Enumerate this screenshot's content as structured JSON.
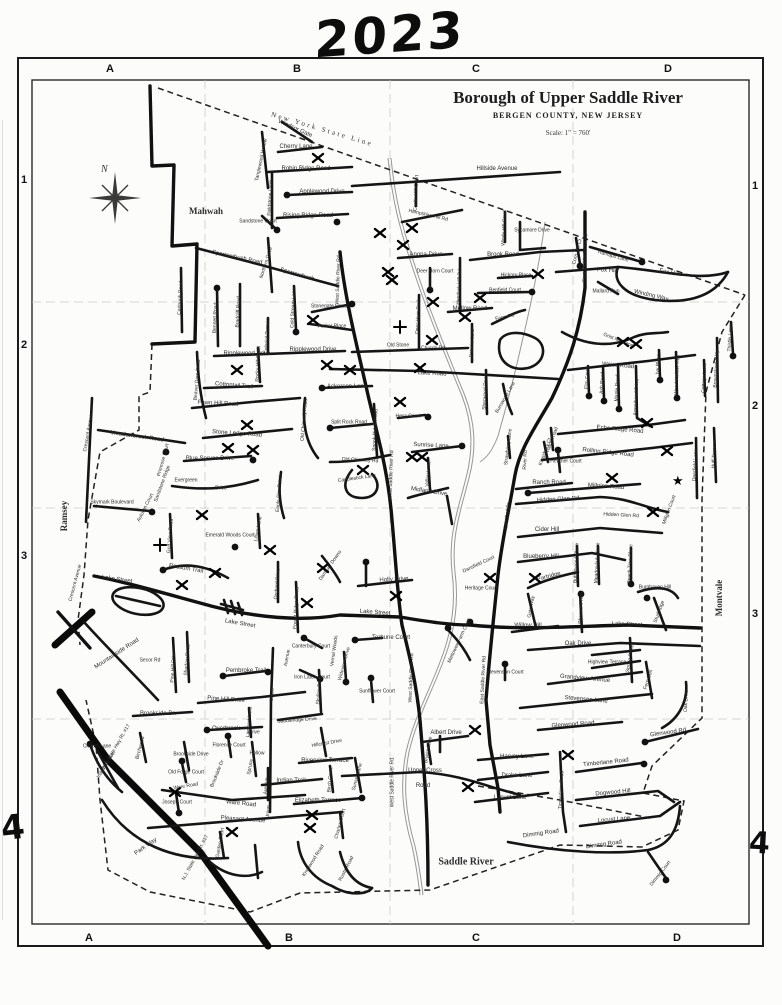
{
  "annotations": {
    "year": "2023",
    "hand4_left": "4",
    "hand4_right": "4"
  },
  "title": {
    "main": "Borough of Upper Saddle River",
    "sub": "BERGEN COUNTY, NEW JERSEY",
    "scale": "Scale: 1\" = 760'"
  },
  "municipalities": {
    "mahwah": "Mahwah",
    "ramsey": "Ramsey",
    "montvale": "Montvale",
    "saddle_river": "Saddle River",
    "state_line": "New York State Line"
  },
  "compass": {
    "north": "N"
  },
  "grid": {
    "top": [
      {
        "t": "A",
        "x": 110
      },
      {
        "t": "B",
        "x": 297
      },
      {
        "t": "C",
        "x": 476
      },
      {
        "t": "D",
        "x": 668
      }
    ],
    "bottom": [
      {
        "t": "A",
        "x": 89
      },
      {
        "t": "B",
        "x": 289
      },
      {
        "t": "C",
        "x": 476
      },
      {
        "t": "D",
        "x": 677
      }
    ],
    "left": [
      {
        "t": "1",
        "y": 180
      },
      {
        "t": "2",
        "y": 345
      },
      {
        "t": "3",
        "y": 556
      }
    ],
    "right": [
      {
        "t": "1",
        "y": 186
      },
      {
        "t": "2",
        "y": 406
      },
      {
        "t": "3",
        "y": 614
      }
    ]
  },
  "street_labels": [
    [
      "Windsor Gate",
      295,
      129,
      24
    ],
    [
      "Cherry Lane",
      296,
      147
    ],
    [
      "Robin Ridge Road",
      306,
      169
    ],
    [
      "Hillside Avenue",
      497,
      169
    ],
    [
      "Applewood Drive",
      322,
      192
    ],
    [
      "Rising Ridge Road",
      308,
      216
    ],
    [
      "Fieldstone Lane",
      271,
      198,
      -87,
      5
    ],
    [
      "Tanglewood Hollow",
      262,
      160,
      -78,
      5
    ],
    [
      "Sandstone Court",
      258,
      222,
      0,
      5
    ],
    [
      "Northern Drive",
      267,
      263,
      -72,
      5
    ],
    [
      "Sparrowbush Road",
      237,
      258,
      12
    ],
    [
      "Sparrowbush",
      297,
      275,
      16
    ],
    [
      "Carlough Road",
      181,
      298,
      -87,
      5
    ],
    [
      "Bennett Road",
      216,
      318,
      -87,
      5
    ],
    [
      "Bradcliff Road",
      239,
      312,
      -87,
      5
    ],
    [
      "Cold Stream Lane",
      294,
      308,
      -87,
      5
    ],
    [
      "Stonegate Road",
      329,
      307,
      0,
      5
    ],
    [
      "Parker Place",
      332,
      327,
      0,
      5
    ],
    [
      "Colonial Terrace",
      268,
      336,
      -87,
      5
    ],
    [
      "West Saddle River Rd",
      339,
      280,
      -88,
      5
    ],
    [
      "Ripplewood Drive",
      247,
      354
    ],
    [
      "Ripplewood Drive",
      313,
      350
    ],
    [
      "Rocky Hill Road",
      259,
      364,
      -87,
      5
    ],
    [
      "Beaver Dam Road",
      198,
      380,
      -85,
      5
    ],
    [
      "Cottontail Trail",
      234,
      386,
      5
    ],
    [
      "Fawn Hill Road",
      218,
      404,
      3
    ],
    [
      "Anona Drive",
      426,
      255
    ],
    [
      "Deer Horn Court",
      435,
      272,
      0,
      5
    ],
    [
      "Deer Horn Trail",
      419,
      317,
      -87,
      5
    ],
    [
      "Hemlock Hill Rd",
      460,
      287,
      -87,
      5
    ],
    [
      "Brook Road",
      503,
      255
    ],
    [
      "Hickory Place",
      516,
      276,
      0,
      5
    ],
    [
      "Benfield Court",
      505,
      291,
      0,
      5
    ],
    [
      "Mellow Road",
      470,
      309
    ],
    [
      "Patricia Lane",
      473,
      343,
      -87,
      5
    ],
    [
      "Farm Rd",
      505,
      318,
      -12,
      5
    ],
    [
      "Old Stone",
      398,
      346,
      0,
      5
    ],
    [
      "Church Rd",
      433,
      349,
      0,
      5
    ],
    [
      "Hampshire Hill Rd",
      428,
      216,
      13,
      5
    ],
    [
      "Castle Hill Court",
      417,
      193,
      -87,
      5
    ],
    [
      "Windy Hill Court",
      505,
      228,
      -87,
      5
    ],
    [
      "Sycamore Drive",
      532,
      231,
      0,
      5
    ],
    [
      "Fox Hill",
      607,
      271,
      3
    ],
    [
      "Fox Hill",
      669,
      273,
      10
    ],
    [
      "Winding Way",
      651,
      296,
      13
    ],
    [
      "Mallard Run",
      606,
      292,
      0,
      5
    ],
    [
      "Ramapo Lane",
      613,
      257,
      16,
      5
    ],
    [
      "Corn Mill Ct",
      578,
      252,
      -75,
      5
    ],
    [
      "East Saddle River Rd",
      586,
      258,
      -88,
      5
    ],
    [
      "Grist Mill Lane",
      618,
      341,
      22,
      5
    ],
    [
      "Weiss Road",
      618,
      366,
      5
    ],
    [
      "Elm Court",
      588,
      378,
      -87,
      5
    ],
    [
      "Ash Road",
      603,
      383,
      -87,
      5
    ],
    [
      "Maple Road",
      618,
      388,
      -87,
      5
    ],
    [
      "Arrowhead Drive",
      637,
      397,
      -87,
      5
    ],
    [
      "Ivy Place",
      659,
      364,
      -87,
      5
    ],
    [
      "Wood Hollow Trail",
      678,
      375,
      -87,
      5
    ],
    [
      "Cottage Lane",
      705,
      378,
      -87,
      5
    ],
    [
      "Brownstone Way",
      717,
      369,
      -87,
      5
    ],
    [
      "Thistle Lane",
      731,
      338,
      -87,
      5
    ],
    [
      "Echo Ridge Road",
      620,
      430,
      5
    ],
    [
      "Rolling Ridge Road",
      608,
      453,
      6
    ],
    [
      "Millglen Road",
      606,
      487,
      4
    ],
    [
      "Millglen Court",
      670,
      510,
      -70,
      5
    ],
    [
      "Ranch Road",
      549,
      483
    ],
    [
      "Hidden Glen Rd",
      558,
      500,
      -3
    ],
    [
      "Hidden Glen Rd",
      621,
      516,
      3,
      5
    ],
    [
      "Heather Court",
      566,
      462,
      0,
      5
    ],
    [
      "Deerfield Lane",
      696,
      465,
      -87,
      5
    ],
    [
      "Huff Terrace",
      715,
      455,
      -87,
      5
    ],
    [
      "Strawberry Lane",
      509,
      447,
      -83,
      5
    ],
    [
      "Kingsbury Ct",
      546,
      452,
      -70,
      5
    ],
    [
      "Ridge Road",
      553,
      440,
      -70,
      5
    ],
    [
      "Burnwood Lane",
      506,
      398,
      -60,
      5
    ],
    [
      "River Rd",
      526,
      460,
      -87,
      5
    ],
    [
      "East Saddle",
      508,
      516,
      -84,
      5
    ],
    [
      "Sherwood Road",
      486,
      392,
      -87,
      5
    ],
    [
      "Cider Hill",
      547,
      530
    ],
    [
      "Blueberry Hill",
      541,
      557
    ],
    [
      "Partridge",
      549,
      577,
      -15
    ],
    [
      "Buttonwood Place",
      577,
      563,
      -87,
      5
    ],
    [
      "Meadowlark Place",
      598,
      563,
      -87,
      5
    ],
    [
      "Peach Tree Place",
      631,
      564,
      -87,
      5
    ],
    [
      "Burghaven Hill",
      655,
      588,
      0,
      5
    ],
    [
      "Sturbridge",
      660,
      612,
      -70,
      5
    ],
    [
      "Gate Way",
      532,
      607,
      -80,
      5
    ],
    [
      "Pheasant Run",
      582,
      608,
      -87,
      5
    ],
    [
      "Willow Hill",
      528,
      626
    ],
    [
      "Lake Street",
      627,
      625,
      2
    ],
    [
      "Oak Drive",
      578,
      644
    ],
    [
      "Highview Terrace",
      607,
      663,
      0,
      5
    ],
    [
      "Grandview Avenue",
      585,
      679,
      5
    ],
    [
      "Stevenson Lane",
      586,
      700,
      5
    ],
    [
      "Stevenson Court",
      505,
      673,
      0,
      5
    ],
    [
      "Spring Street",
      631,
      658,
      -80,
      5
    ],
    [
      "Fern Dell",
      649,
      680,
      -72,
      5
    ],
    [
      "Oak Drive",
      687,
      701,
      -87,
      5
    ],
    [
      "Dansfield Court",
      479,
      565,
      -25,
      5
    ],
    [
      "Heritage Court",
      481,
      589,
      0,
      5
    ],
    [
      "Mettowee Farm Court",
      460,
      641,
      -65,
      5
    ],
    [
      "East Saddle River Rd",
      484,
      680,
      -87,
      5
    ],
    [
      "West Saddle River Rd",
      412,
      678,
      -88,
      5
    ],
    [
      "Holly Drive",
      394,
      580,
      -3
    ],
    [
      "Lake Street",
      375,
      613,
      4
    ],
    [
      "Terhune Court",
      391,
      638
    ],
    [
      "Danbury Downs",
      331,
      566,
      -55,
      5
    ],
    [
      "Vernal Woods",
      335,
      651,
      -82,
      5
    ],
    [
      "Wideview Drive",
      345,
      664,
      -75,
      5
    ],
    [
      "Skyline Drive",
      320,
      690,
      -85,
      5
    ],
    [
      "Sunflower Court",
      377,
      692,
      0,
      5
    ],
    [
      "Canterbury Court",
      311,
      647,
      0,
      5
    ],
    [
      "Iron Latch Court",
      312,
      678,
      0,
      5
    ],
    [
      "Union",
      273,
      695,
      -85,
      5
    ],
    [
      "Avenue",
      288,
      658,
      -80,
      5
    ],
    [
      "Forest Ridge Road",
      297,
      608,
      -87,
      5
    ],
    [
      "Orchard Drive",
      278,
      584,
      -85,
      5
    ],
    [
      "Pembroke Trail",
      246,
      671
    ],
    [
      "Pine Hill Drive",
      174,
      667,
      -87,
      5
    ],
    [
      "Shadow Road",
      188,
      660,
      -85,
      5
    ],
    [
      "Pine Hill Drive",
      226,
      700,
      4
    ],
    [
      "Brookside Dr.",
      158,
      714
    ],
    [
      "Overbrook",
      226,
      729
    ],
    [
      "Drive",
      254,
      733,
      0,
      5
    ],
    [
      "Lambert Lane",
      250,
      722,
      -85,
      5
    ],
    [
      "Saddleridge Drive",
      297,
      721,
      -4,
      5
    ],
    [
      "Secor Rd",
      150,
      661,
      0,
      5
    ],
    [
      "Mountainside Road",
      117,
      654,
      -33
    ],
    [
      "Lake Street",
      117,
      580,
      8
    ],
    [
      "Lake Street",
      240,
      624,
      10
    ],
    [
      "Possum Trail",
      186,
      569,
      10
    ],
    [
      "Crescent Avenue",
      89,
      433,
      -80,
      5
    ],
    [
      "Crescent Avenue",
      76,
      583,
      -75,
      5
    ],
    [
      "Meadowbrook Road",
      137,
      437,
      8
    ],
    [
      "Stone Ledge Road",
      237,
      434,
      4
    ],
    [
      "Blue Spruce Drive",
      210,
      459
    ],
    [
      "Primrose Court",
      164,
      460,
      -75,
      5
    ],
    [
      "Sandstone Ridge",
      163,
      484,
      -70,
      5
    ],
    [
      "Evergreen",
      186,
      481,
      0,
      5
    ],
    [
      "Drive",
      221,
      489,
      0,
      5
    ],
    [
      "Skymark Boulevard",
      112,
      503,
      0,
      5
    ],
    [
      "Autumn Court",
      146,
      508,
      -63,
      5
    ],
    [
      "Golf View Road",
      171,
      536,
      -85,
      5
    ],
    [
      "Emerald Woods Court",
      230,
      536,
      0,
      5
    ],
    [
      "Lillian Lane",
      259,
      529,
      -80,
      5
    ],
    [
      "Eagle Rim Road",
      280,
      494,
      -85,
      5
    ],
    [
      "Split Rock Road",
      349,
      423,
      0,
      5
    ],
    [
      "Spook Ridge Road",
      376,
      430,
      -87,
      5
    ],
    [
      "Old Chimney Rd",
      360,
      461,
      3,
      5
    ],
    [
      "Old Chimney Road",
      305,
      420,
      -85,
      5
    ],
    [
      "Candlestick Lane",
      357,
      479,
      -8,
      5
    ],
    [
      "Ackerson Lane",
      347,
      387
    ],
    [
      "Lake Road",
      432,
      374,
      3
    ],
    [
      "Hess Court",
      408,
      417,
      0,
      5
    ],
    [
      "Sunrise Lane",
      431,
      446,
      3
    ],
    [
      "Valley Lane",
      429,
      474,
      -85,
      5
    ],
    [
      "Midland Drive",
      429,
      492,
      9
    ],
    [
      "West Saddle River Rd",
      392,
      475,
      -88,
      5
    ],
    [
      "Chapel Lane",
      97,
      747,
      0,
      5
    ],
    [
      "Industrial Ave.",
      107,
      765,
      -58,
      5
    ],
    [
      "N.J. State Hwy Rt. #17",
      117,
      747,
      -60,
      5
    ],
    [
      "N.J. State Hwy Rt. #17",
      196,
      858,
      -62,
      5
    ],
    [
      "Birchwood",
      141,
      748,
      -75,
      5
    ],
    [
      "Brookside Drive",
      191,
      755,
      0,
      5
    ],
    [
      "Florence Court",
      229,
      746,
      0,
      5
    ],
    [
      "Old Forge Court",
      186,
      773,
      0,
      5
    ],
    [
      "Brookside Dr",
      218,
      774,
      -68,
      5
    ],
    [
      "Hollow",
      257,
      754,
      0,
      5
    ],
    [
      "Spruce",
      251,
      767,
      -80,
      5
    ],
    [
      "Avenue",
      267,
      786,
      -85,
      5
    ],
    [
      "Indian Trail",
      291,
      781
    ],
    [
      "Ware Road",
      186,
      787,
      -10,
      5
    ],
    [
      "Joseph Court",
      177,
      803,
      0,
      5
    ],
    [
      "Ware Road",
      241,
      804,
      6
    ],
    [
      "Elizabeth Terrace",
      318,
      801
    ],
    [
      "Pleasant Avenue",
      243,
      820,
      4
    ],
    [
      "Union",
      269,
      812,
      -85,
      5
    ],
    [
      "Park Way",
      146,
      847,
      -35
    ],
    [
      "Garden Court",
      221,
      843,
      -80,
      5
    ],
    [
      "Hillcrest Drive",
      327,
      744,
      -10,
      5
    ],
    [
      "Riverview Terrace",
      325,
      761
    ],
    [
      "Sunset Lane",
      358,
      777,
      -75,
      5
    ],
    [
      "Birch Court",
      331,
      780,
      -85,
      5
    ],
    [
      "Charles Court",
      341,
      824,
      -75,
      5
    ],
    [
      "Knollwood Road",
      314,
      861,
      -58,
      5
    ],
    [
      "Rustic Road",
      347,
      869,
      -63,
      5
    ],
    [
      "West Saddle River Rd.",
      393,
      782,
      -90,
      5
    ],
    [
      "Upper Cross",
      425,
      771
    ],
    [
      "Road",
      423,
      786
    ],
    [
      "Albert Drive",
      446,
      733
    ],
    [
      "Bryers Lane",
      429,
      750,
      -80,
      5
    ],
    [
      "Harvey Lane",
      517,
      757
    ],
    [
      "Drake Lane",
      517,
      776
    ],
    [
      "Locust Lane",
      510,
      798
    ],
    [
      "Glenwood Road",
      573,
      725,
      -4
    ],
    [
      "Glenwood Rd.",
      669,
      733,
      -8
    ],
    [
      "Timberlane Road",
      562,
      790,
      -87,
      5
    ],
    [
      "Timberlane Road",
      606,
      763,
      -6
    ],
    [
      "Dogwood Hill",
      613,
      793,
      -5
    ],
    [
      "Locust Lane",
      614,
      820,
      -5
    ],
    [
      "Dimmig Road",
      541,
      834,
      -8
    ],
    [
      "Dimmig Road",
      604,
      845,
      -8
    ],
    [
      "Dimmig Court",
      661,
      874,
      -52,
      5
    ]
  ],
  "marks": {
    "x": [
      [
        318,
        158
      ],
      [
        412,
        228
      ],
      [
        380,
        233
      ],
      [
        403,
        245
      ],
      [
        388,
        272
      ],
      [
        392,
        280
      ],
      [
        538,
        274
      ],
      [
        313,
        320
      ],
      [
        433,
        302
      ],
      [
        480,
        298
      ],
      [
        465,
        317
      ],
      [
        432,
        340
      ],
      [
        237,
        370
      ],
      [
        327,
        365
      ],
      [
        350,
        370
      ],
      [
        420,
        368
      ],
      [
        400,
        402
      ],
      [
        412,
        457
      ],
      [
        422,
        457
      ],
      [
        363,
        470
      ],
      [
        247,
        425
      ],
      [
        228,
        448
      ],
      [
        253,
        450
      ],
      [
        202,
        515
      ],
      [
        270,
        550
      ],
      [
        182,
        585
      ],
      [
        215,
        573
      ],
      [
        307,
        603
      ],
      [
        396,
        596
      ],
      [
        323,
        568
      ],
      [
        490,
        578
      ],
      [
        535,
        578
      ],
      [
        647,
        423
      ],
      [
        667,
        451
      ],
      [
        612,
        478
      ],
      [
        653,
        512
      ],
      [
        623,
        342
      ],
      [
        636,
        344
      ],
      [
        568,
        755
      ],
      [
        475,
        730
      ],
      [
        468,
        787
      ],
      [
        312,
        815
      ],
      [
        310,
        828
      ],
      [
        232,
        832
      ],
      [
        175,
        792
      ]
    ],
    "plus": [
      [
        160,
        545
      ],
      [
        400,
        327
      ]
    ],
    "star": [
      [
        678,
        481
      ]
    ]
  },
  "dots": [
    [
      287,
      195
    ],
    [
      337,
      222
    ],
    [
      277,
      230
    ],
    [
      296,
      332
    ],
    [
      352,
      304
    ],
    [
      217,
      288
    ],
    [
      430,
      290
    ],
    [
      532,
      292
    ],
    [
      428,
      417
    ],
    [
      322,
      388
    ],
    [
      330,
      428
    ],
    [
      462,
      446
    ],
    [
      166,
      452
    ],
    [
      253,
      460
    ],
    [
      152,
      512
    ],
    [
      235,
      547
    ],
    [
      163,
      570
    ],
    [
      223,
      676
    ],
    [
      268,
      672
    ],
    [
      207,
      730
    ],
    [
      362,
      798
    ],
    [
      355,
      640
    ],
    [
      346,
      682
    ],
    [
      371,
      678
    ],
    [
      366,
      562
    ],
    [
      505,
      664
    ],
    [
      631,
      584
    ],
    [
      581,
      594
    ],
    [
      647,
      598
    ],
    [
      528,
      493
    ],
    [
      558,
      450
    ],
    [
      589,
      396
    ],
    [
      604,
      401
    ],
    [
      619,
      409
    ],
    [
      660,
      380
    ],
    [
      677,
      398
    ],
    [
      733,
      356
    ],
    [
      642,
      262
    ],
    [
      580,
      266
    ],
    [
      645,
      742
    ],
    [
      644,
      764
    ],
    [
      666,
      880
    ],
    [
      448,
      628
    ],
    [
      470,
      622
    ],
    [
      90,
      744
    ],
    [
      228,
      736
    ],
    [
      182,
      761
    ],
    [
      179,
      813
    ],
    [
      320,
      679
    ],
    [
      304,
      638
    ]
  ]
}
